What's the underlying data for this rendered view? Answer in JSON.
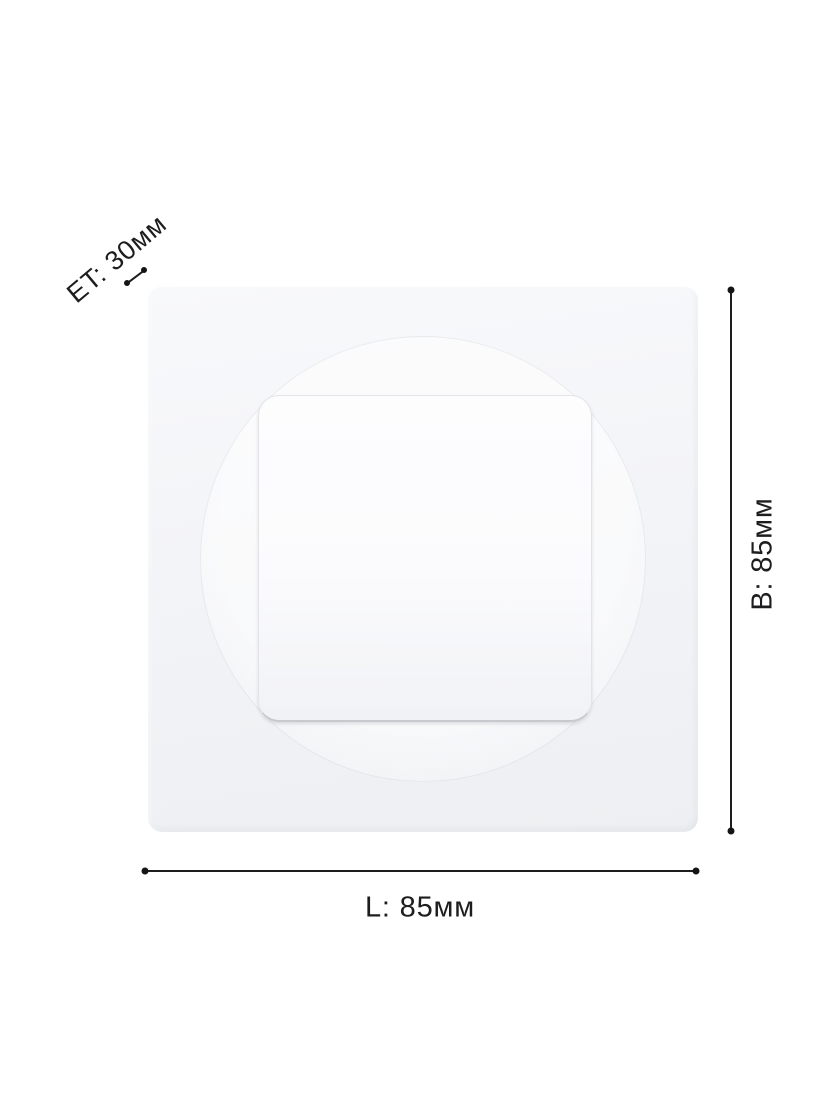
{
  "diagram": {
    "type": "product-dimensions",
    "labels": {
      "length": "L: 85мм",
      "height": "B: 85мм",
      "depth": "ET: 30мм"
    },
    "measurements": {
      "length_mm": 85,
      "height_mm": 85,
      "depth_mm": 30
    },
    "colors": {
      "background": "#ffffff",
      "annotation_text": "#1d1d1f",
      "annotation_line": "#1d1d1f",
      "panel_face": "#f3f4f7",
      "inner_light_face": "#fbfbfd",
      "inner_light_edge": "#c7c9cd"
    }
  }
}
